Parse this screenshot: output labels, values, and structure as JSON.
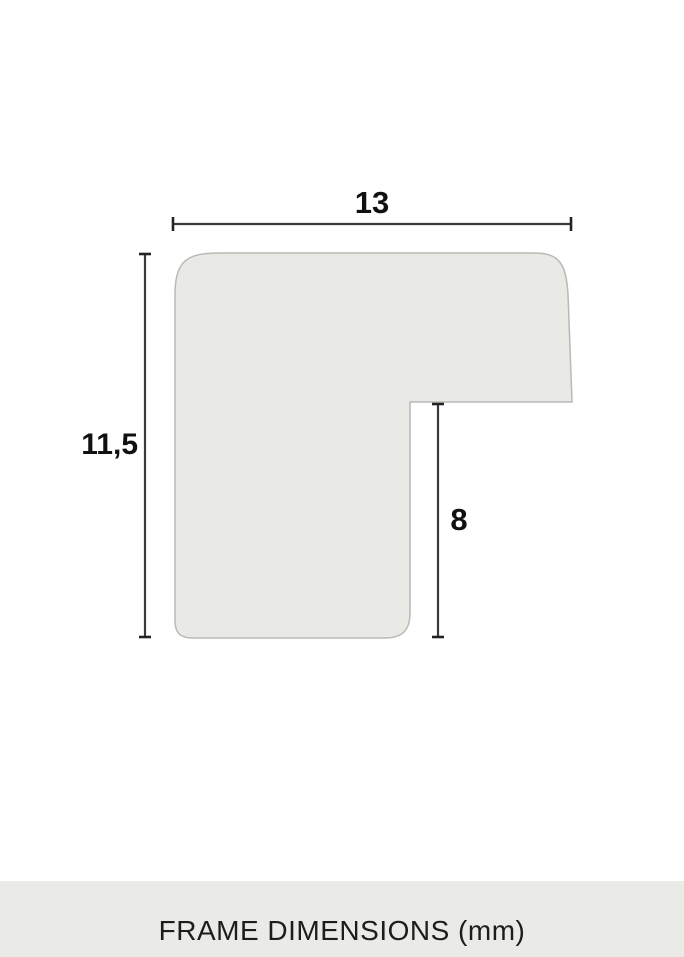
{
  "diagram": {
    "unit": "mm",
    "width_label": "13",
    "height_label": "11,5",
    "rabbet_label": "8"
  },
  "footer": {
    "caption": "FRAME DIMENSIONS (mm)"
  },
  "colors": {
    "background": "#ffffff",
    "shape_fill": "#e9e9e5",
    "shape_outline": "#b9b9b5",
    "dimension_line": "#3a3a3a",
    "tick": "#232323",
    "label_text": "#111111",
    "footer_bg": "#eaeae6",
    "footer_text": "#1d1d1b"
  }
}
